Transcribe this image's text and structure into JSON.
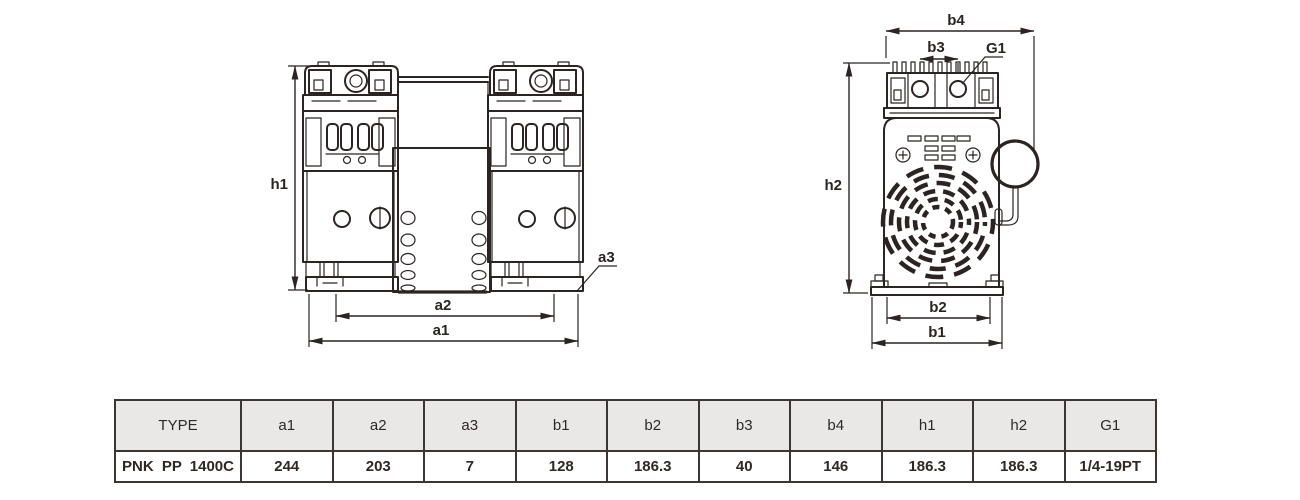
{
  "colors": {
    "ink": "#2b2422",
    "table_header_bg": "#e9e8e6",
    "table_border": "#3c3532",
    "background": "#ffffff"
  },
  "drawing": {
    "description": "Two-view dimensional drawing of PNK PP 1400C twin-head piston vacuum pump",
    "front_view": {
      "dim_labels": {
        "h1": "h1",
        "a1": "a1",
        "a2": "a2",
        "a3": "a3"
      }
    },
    "side_view": {
      "dim_labels": {
        "h2": "h2",
        "b1": "b1",
        "b2": "b2",
        "b3": "b3",
        "b4": "b4",
        "G1": "G1"
      }
    }
  },
  "table": {
    "headers": [
      "TYPE",
      "a1",
      "a2",
      "a3",
      "b1",
      "b2",
      "b3",
      "b4",
      "h1",
      "h2",
      "G1"
    ],
    "rows": [
      [
        "PNK PP 1400C",
        "244",
        "203",
        "7",
        "128",
        "186.3",
        "40",
        "146",
        "186.3",
        "186.3",
        "1/4-19PT"
      ]
    ]
  }
}
